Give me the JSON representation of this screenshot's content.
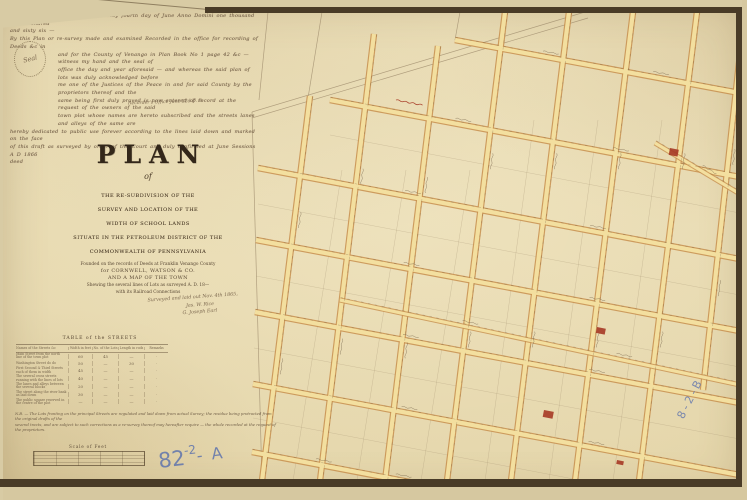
{
  "page": {
    "kind": "scanned manuscript town plan"
  },
  "handwriting": {
    "lines": [
      "Be it remembered that on the twenty fourth day of June Anno Domini one thousand eight hundred",
      "and sixty six —",
      "By this Plan or re-survey made and examined Recorded in the office for recording of Deeds &c in",
      "and for the County of Venango in Plan Book No 1 page 42 &c — witness my hand and the seal of",
      "office the day and year aforesaid — and whereas the said plan of lots was duly acknowledged before",
      "me one of the Justices of the Peace in and for said County by the proprietors thereof and the",
      "same being first duly proved is now entered of record at the request of the owners of the said",
      "town plot whose names are hereto subscribed and the streets lanes and alleys of the same are",
      "hereby dedicated to public use forever according to the lines laid down and marked on the face",
      "of this draft as surveyed by order of the Court and duly confirmed at June Sessions A D 1866",
      "deed"
    ],
    "seal_label": "Seal",
    "office_line": "Recorder's Office June 22d D. B."
  },
  "title": {
    "main": "PLAN",
    "of": "of",
    "lines": [
      "THE RE-SUBDIVISION OF THE",
      "SURVEY AND LOCATION OF THE",
      "WIDTH OF SCHOOL LANDS",
      "SITUATE IN THE PETROLEUM DISTRICT OF THE",
      "COMMONWEALTH OF PENNSYLVANIA"
    ],
    "sublines": [
      "Founded on the records of Deeds at Franklin Venango County",
      "for CORNWELL, WATSON & CO.",
      "AND A MAP OF THE TOWN",
      "Shewing the several lines of Lots as surveyed A. D. 18—",
      "with its Railroad Connections"
    ]
  },
  "signature": {
    "lines": [
      "Surveyed and laid out Nov. 4th 1865,",
      "Jas. W. Rice",
      "G. Joseph Earl"
    ]
  },
  "table": {
    "title": "TABLE of the STREETS",
    "header": [
      "Names of the Streets &c",
      "Width in feet",
      "No. of the Lots",
      "Length in rods",
      "Remarks"
    ],
    "rows": [
      [
        "Main Street from the north line of the town plot",
        "60",
        "45",
        "—",
        "·"
      ],
      [
        "Washington Street do do",
        "50",
        "—",
        "30",
        "·"
      ],
      [
        "First Second & Third Streets each of them in width",
        "45",
        "—",
        "—",
        "·"
      ],
      [
        "The several cross streets running with the lines of lots",
        "40",
        "—",
        "—",
        "·"
      ],
      [
        "The lanes and alleys between the several blocks",
        "20",
        "—",
        "—",
        "·"
      ],
      [
        "The street along the river bank as laid down",
        "30",
        "—",
        "—",
        "·"
      ],
      [
        "The public square reserved in the centre of the plot",
        "—",
        "—",
        "—",
        "·"
      ]
    ]
  },
  "footnote": {
    "lines": [
      "N.B. — The Lots fronting on the principal Streets are regulated and laid down from actual Survey; the residue being protracted from the original drafts of the",
      "several tracts, and are subject to such corrections as a re-survey thereof may hereafter require — the whole recorded at the request of the proprietors."
    ]
  },
  "scalebar": {
    "label": "Scale of Feet"
  },
  "archive": {
    "a_base": "82",
    "a_sup": "-2",
    "a_suffix": "- A",
    "b": "8-2-B"
  },
  "map": {
    "colors": {
      "street_edge": "#c8904e",
      "street_fill": "#f3df9f",
      "ink": "#6f5d45",
      "faint": "#9d8a6b",
      "red": "#a63825",
      "frame": "#493b27",
      "blue": "#5f74ad"
    },
    "horizontals": [
      [
        455,
        40,
        745,
        94
      ],
      [
        330,
        100,
        745,
        178
      ],
      [
        258,
        168,
        745,
        260
      ],
      [
        256,
        240,
        745,
        332
      ],
      [
        255,
        312,
        745,
        404
      ],
      [
        253,
        384,
        745,
        476
      ],
      [
        252,
        452,
        462,
        492
      ]
    ],
    "verticals": [
      [
        310,
        96,
        262,
        481
      ],
      [
        374,
        34,
        320,
        481
      ],
      [
        438,
        46,
        385,
        481
      ],
      [
        505,
        12,
        447,
        481
      ],
      [
        569,
        12,
        511,
        481
      ],
      [
        633,
        12,
        575,
        481
      ],
      [
        697,
        12,
        639,
        481
      ],
      [
        741,
        45,
        703,
        390
      ]
    ],
    "diagonals": [
      [
        655,
        143,
        745,
        197
      ],
      [
        340,
        300,
        745,
        386
      ]
    ],
    "faint": [
      [
        252,
        112,
        585,
        12
      ],
      [
        252,
        118,
        588,
        18
      ],
      [
        252,
        112,
        262,
        481
      ],
      [
        322,
        12,
        308,
        98
      ],
      [
        268,
        12,
        259,
        100
      ],
      [
        460,
        12,
        455,
        40
      ]
    ],
    "mids_v": [
      [
        342,
        170,
        293,
        481
      ],
      [
        406,
        170,
        357,
        481
      ],
      [
        470,
        170,
        421,
        481
      ],
      [
        534,
        120,
        485,
        481
      ],
      [
        598,
        120,
        549,
        481
      ],
      [
        662,
        120,
        613,
        481
      ]
    ],
    "mids_h": [
      [
        330,
        135,
        745,
        214
      ],
      [
        258,
        204,
        745,
        296
      ],
      [
        256,
        276,
        745,
        368
      ],
      [
        254,
        348,
        745,
        440
      ],
      [
        253,
        418,
        600,
        484
      ]
    ],
    "red_blocks": [
      [
        670,
        148,
        9,
        7,
        11
      ],
      [
        597,
        327,
        9,
        6,
        11
      ],
      [
        544,
        410,
        10,
        7,
        11
      ],
      [
        617,
        460,
        7,
        4,
        11
      ]
    ],
    "red_squiggle": {
      "x": 396,
      "y": 100,
      "angle": 11,
      "len": 27
    }
  }
}
